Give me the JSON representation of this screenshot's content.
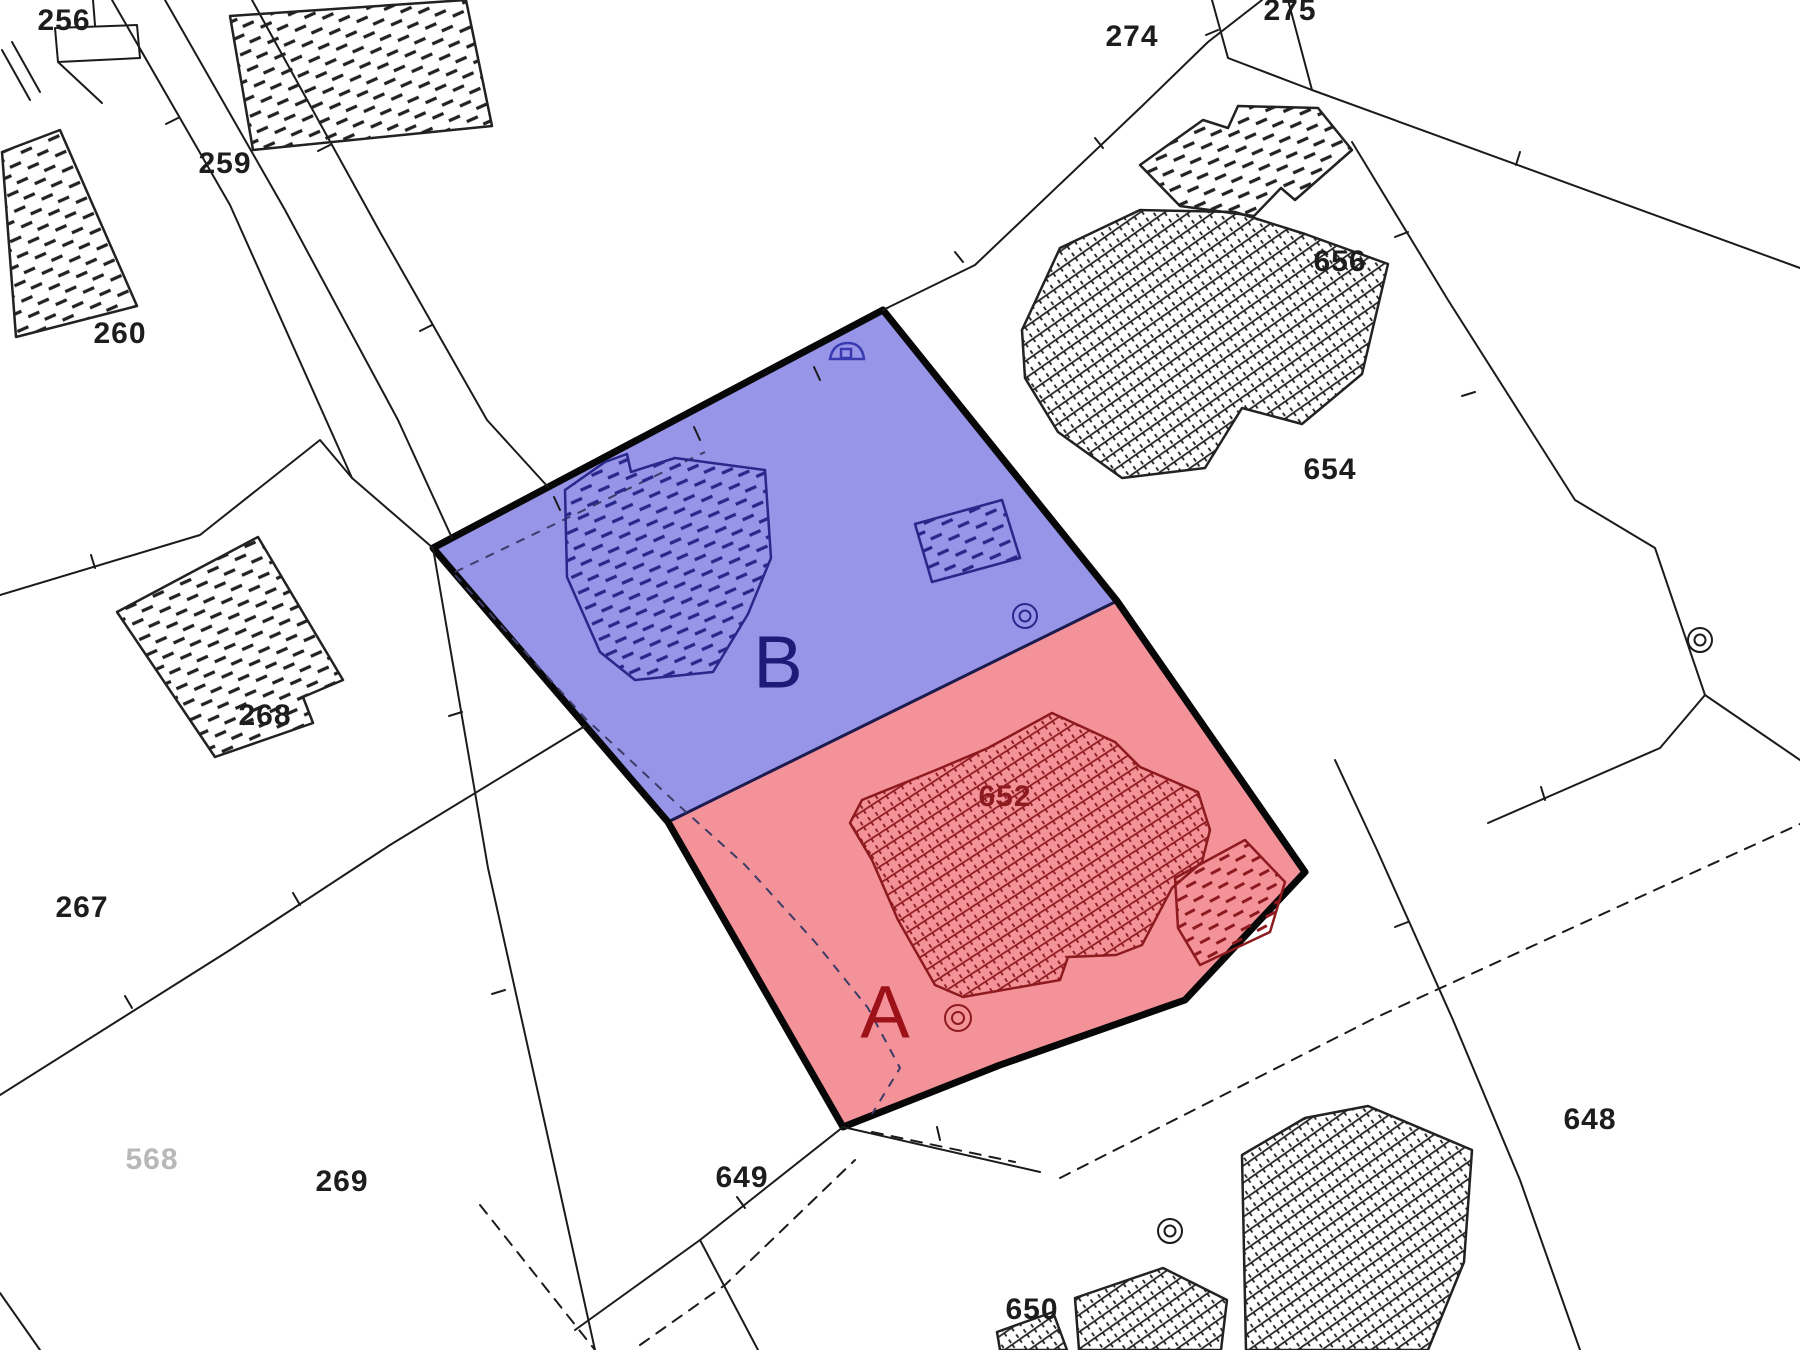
{
  "map": {
    "title": "Cadastral parcel plan with surveyed plots A and B",
    "type": "cadastral-plan",
    "colors": {
      "background": "#ffffff",
      "line_work": "#1b1b1b",
      "parcel_outline": "#070707",
      "highlight_b_fill": "#9795e8",
      "highlight_a_fill": "#f4929a",
      "divider_line": "#1b1b4e",
      "building_navy": "#28288a",
      "building_dark_red": "#8d1a1f",
      "gray_label": "#b8b8b8"
    },
    "highlights": {
      "b": {
        "label": "B",
        "label_color": "#1c1c78",
        "fill": "#9795e8"
      },
      "a": {
        "label": "A",
        "label_color": "#9c1218",
        "fill": "#f4929a"
      }
    },
    "parcel_numbers": {
      "p256": "256",
      "p259": "259",
      "p260": "260",
      "p267": "267",
      "p268": "268",
      "p269": "269",
      "p274": "274",
      "p275": "275",
      "p568": "568",
      "p648": "648",
      "p649": "649",
      "p650": "650",
      "p652": "652",
      "p654": "654",
      "p656": "656"
    },
    "markers": {
      "survey_marker": "double-circle boundary marker",
      "building_symbol": "small outbuilding symbol"
    }
  }
}
